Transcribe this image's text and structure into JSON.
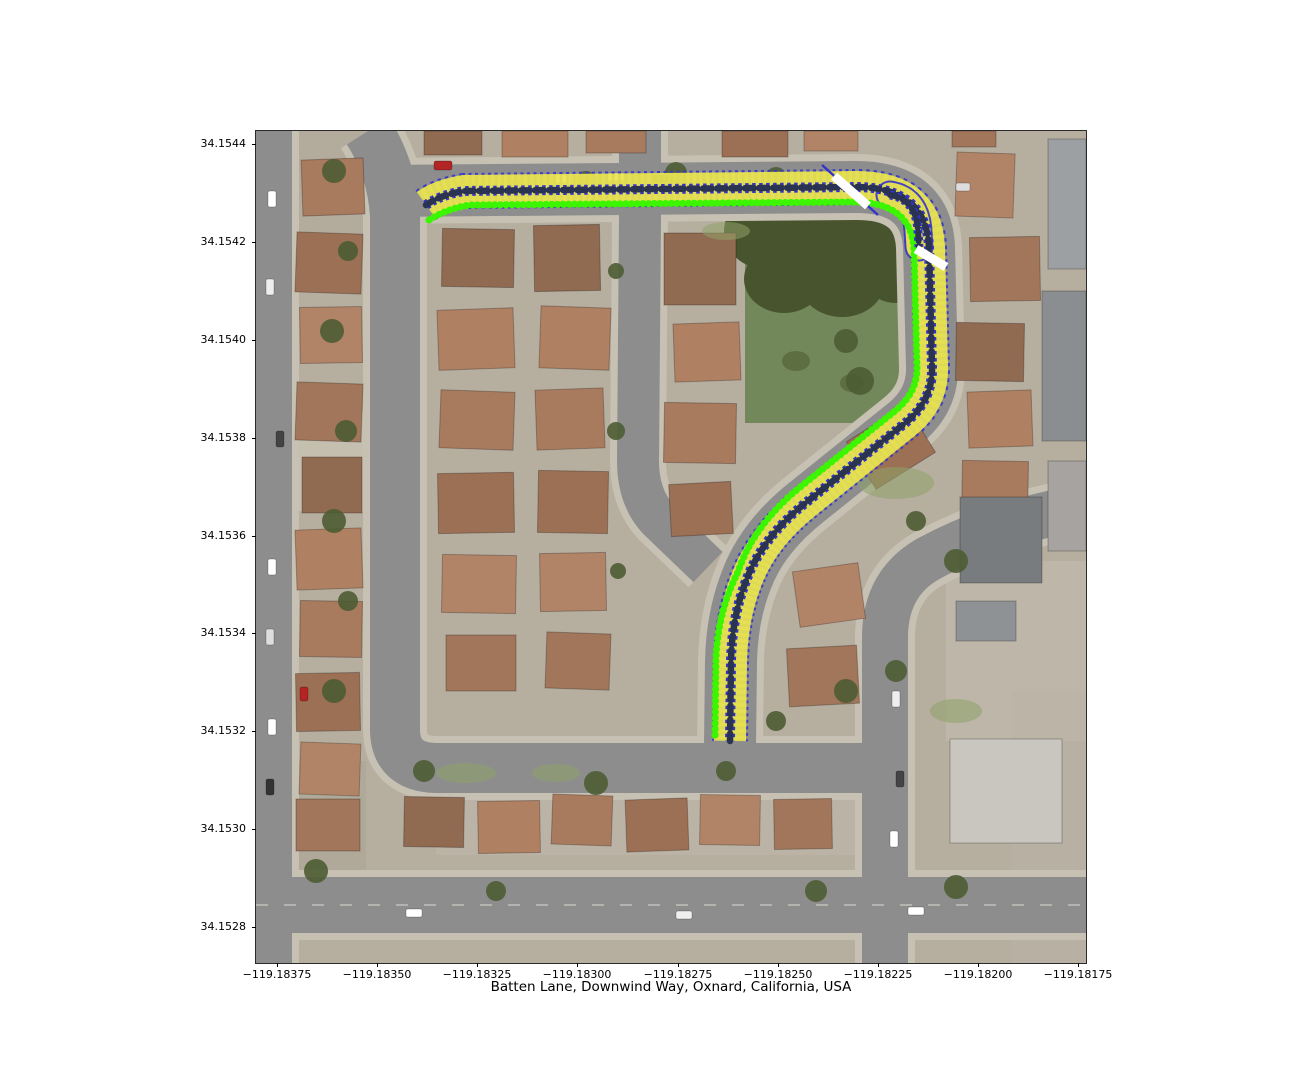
{
  "figure": {
    "background": "#ffffff"
  },
  "axes": {
    "xlabel": "Batten Lane, Downwind Way, Oxnard, California, USA",
    "x_ticks": [
      "−119.18375",
      "−119.18350",
      "−119.18325",
      "−119.18300",
      "−119.18275",
      "−119.18250",
      "−119.18225",
      "−119.18200",
      "−119.18175"
    ],
    "y_ticks": [
      "34.1544",
      "34.1542",
      "34.1540",
      "34.1538",
      "34.1536",
      "34.1534",
      "34.1532",
      "34.1530",
      "34.1528"
    ]
  },
  "map": {
    "type": "satellite-imagery-with-route-overlay",
    "place": "Oxnard, California, USA",
    "streets_highlighted": [
      "Batten Lane",
      "Downwind Way"
    ],
    "route": {
      "band_color": "#ece64d",
      "band_outline_color": "#3434cc",
      "centerline_color": "#2b3352",
      "edge_line_color": "#3cf500",
      "direction_marker_color": "#ffffff",
      "waypoints_lonlat": [
        [
          -119.18338,
          34.15428
        ],
        [
          -119.18294,
          34.1543
        ],
        [
          -119.18227,
          34.15431
        ],
        [
          -119.18211,
          34.15416
        ],
        [
          -119.18212,
          34.15392
        ],
        [
          -119.18247,
          34.15363
        ],
        [
          -119.18261,
          34.15337
        ],
        [
          -119.18262,
          34.15318
        ]
      ]
    },
    "surface_colors": {
      "asphalt": "#8d8d8d",
      "sidewalk": "#c6c1b3",
      "ground": "#b6ae9f",
      "lawn": "#73885a",
      "tree": "#4c5c33"
    }
  }
}
